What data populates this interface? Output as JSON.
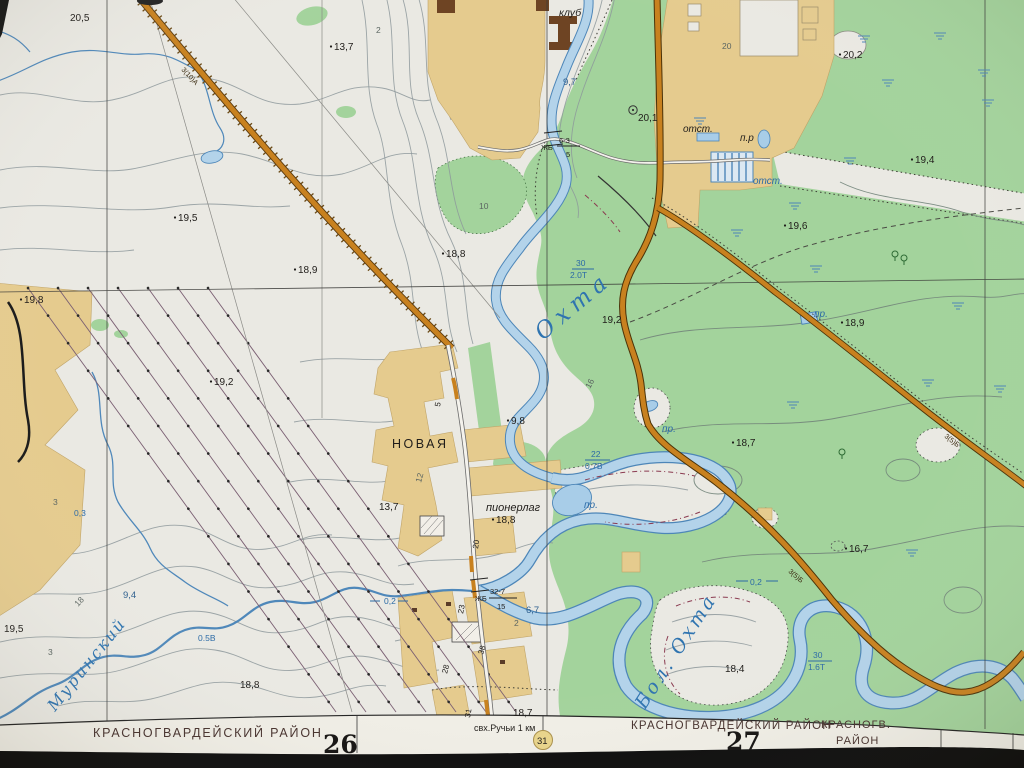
{
  "map": {
    "colors": {
      "paper": "#eae9e3",
      "margin_paper": "#f0eee6",
      "forest_green": "#a3d39c",
      "built_tan": "#e5cb8e",
      "water_fill": "#b3d3ea",
      "water_edge": "#4d86b8",
      "road_orange": "#c8811f",
      "road_edge": "#5a3b10",
      "building_brown": "#6e4423",
      "power_line": "#7a5f72",
      "district_text": "#46312d",
      "photo_edge_black": "#0b0b0b",
      "marker_circle_fill": "#e8d48a"
    },
    "labels": [
      {
        "t": "20,5",
        "x": 70,
        "y": 21,
        "n": "elevation-label"
      },
      {
        "t": "13,7",
        "x": 334,
        "y": 50,
        "dot": 1,
        "n": "elevation-label"
      },
      {
        "t": "19,5",
        "x": 178,
        "y": 221,
        "dot": 1,
        "n": "elevation-label"
      },
      {
        "t": "18,8",
        "x": 446,
        "y": 257,
        "dot": 1,
        "n": "elevation-label"
      },
      {
        "t": "18,9",
        "x": 298,
        "y": 273,
        "dot": 1,
        "n": "elevation-label"
      },
      {
        "t": "19,8",
        "x": 24,
        "y": 303,
        "dot": 1,
        "n": "elevation-label"
      },
      {
        "t": "19,2",
        "x": 214,
        "y": 385,
        "dot": 1,
        "n": "elevation-label"
      },
      {
        "t": "13,7",
        "x": 379,
        "y": 510,
        "n": "elevation-label"
      },
      {
        "t": "19,5",
        "x": 4,
        "y": 632,
        "n": "elevation-label"
      },
      {
        "t": "18,8",
        "x": 240,
        "y": 688,
        "n": "elevation-label"
      },
      {
        "t": "9,4",
        "x": 123,
        "y": 598,
        "c": "bluU",
        "n": "water-elevation-label"
      },
      {
        "t": "0.5В",
        "x": 198,
        "y": 641,
        "c": "bluS",
        "n": "river-depth-label"
      },
      {
        "t": "0,3",
        "x": 74,
        "y": 516,
        "c": "bluS",
        "n": "river-width-label"
      },
      {
        "t": "20,1",
        "x": 638,
        "y": 121,
        "n": "elevation-label"
      },
      {
        "t": "20,2",
        "x": 843,
        "y": 58,
        "dot": 1,
        "n": "elevation-label"
      },
      {
        "t": "19,4",
        "x": 915,
        "y": 163,
        "dot": 1,
        "n": "elevation-label"
      },
      {
        "t": "19,6",
        "x": 788,
        "y": 229,
        "dot": 1,
        "n": "elevation-label"
      },
      {
        "t": "18,9",
        "x": 845,
        "y": 326,
        "dot": 1,
        "n": "elevation-label"
      },
      {
        "t": "18,7",
        "x": 736,
        "y": 446,
        "dot": 1,
        "n": "elevation-label"
      },
      {
        "t": "16,7",
        "x": 849,
        "y": 552,
        "dot": 1,
        "n": "elevation-label"
      },
      {
        "t": "18,4",
        "x": 725,
        "y": 672,
        "n": "elevation-label"
      },
      {
        "t": "19,2",
        "x": 602,
        "y": 323,
        "n": "elevation-label"
      },
      {
        "t": "9,8",
        "x": 511,
        "y": 424,
        "dot": 1,
        "n": "elevation-label"
      },
      {
        "t": "18,8",
        "x": 496,
        "y": 523,
        "dot": 1,
        "n": "elevation-label"
      },
      {
        "t": "18,7",
        "x": 513,
        "y": 716,
        "n": "elevation-label"
      },
      {
        "t": "6,7",
        "x": 526,
        "y": 613,
        "c": "bluU",
        "n": "elevation-label"
      },
      {
        "t": "9,7",
        "x": 563,
        "y": 85,
        "c": "bluU",
        "n": "water-elevation-label"
      },
      {
        "t": "отст.",
        "x": 683,
        "y": 132,
        "c": "blkI",
        "n": "settling-pond-label"
      },
      {
        "t": "п.р",
        "x": 740,
        "y": 141,
        "c": "blkI",
        "n": "pond-label"
      },
      {
        "t": "отст.",
        "x": 753,
        "y": 184,
        "c": "blu",
        "n": "settling-pond-label"
      },
      {
        "t": "пр.",
        "x": 814,
        "y": 317,
        "c": "blu",
        "n": "pond-label"
      },
      {
        "t": "пр.",
        "x": 662,
        "y": 432,
        "c": "blu",
        "n": "pond-label"
      },
      {
        "t": "пр.",
        "x": 584,
        "y": 508,
        "c": "blu",
        "n": "pond-label"
      },
      {
        "t": "30",
        "x": 576,
        "y": 266,
        "c": "bluS",
        "n": "river-width-label"
      },
      {
        "t": "2.0Т",
        "x": 570,
        "y": 278,
        "c": "bluS",
        "n": "river-depth-label"
      },
      {
        "t": "22",
        "x": 591,
        "y": 457,
        "c": "bluS",
        "n": "river-width-label"
      },
      {
        "t": "0.7В",
        "x": 585,
        "y": 469,
        "c": "bluS",
        "n": "river-depth-label"
      },
      {
        "t": "30",
        "x": 813,
        "y": 658,
        "c": "bluS",
        "n": "river-width-label"
      },
      {
        "t": "1.6Т",
        "x": 808,
        "y": 670,
        "c": "bluS",
        "n": "river-depth-label"
      },
      {
        "t": "0,2",
        "x": 750,
        "y": 585,
        "c": "bluS",
        "n": "stream-width-label"
      },
      {
        "t": "0,2",
        "x": 384,
        "y": 604,
        "c": "bluS",
        "n": "stream-width-label"
      },
      {
        "t": "Охта",
        "x": 543,
        "y": 341,
        "c": "riv",
        "s": 23,
        "r": -40,
        "ls": 6,
        "n": "river-name-okhta"
      },
      {
        "t": "Бол. Охта",
        "x": 645,
        "y": 710,
        "c": "riv",
        "s": 19,
        "r": -57,
        "ls": 3,
        "n": "river-name-bolshaya-okhta"
      },
      {
        "t": "Муринский",
        "x": 55,
        "y": 712,
        "c": "riv",
        "s": 16,
        "r": -51,
        "ls": 2,
        "n": "stream-name-murinsky"
      },
      {
        "t": "20",
        "x": 722,
        "y": 49,
        "c": "ctr",
        "n": "contour-label"
      },
      {
        "t": "10",
        "x": 479,
        "y": 209,
        "c": "ctr",
        "n": "contour-label"
      },
      {
        "t": "16",
        "x": 590,
        "y": 389,
        "c": "ctr",
        "r": -62,
        "n": "contour-label"
      },
      {
        "t": "12",
        "x": 421,
        "y": 483,
        "c": "ctr",
        "r": -75,
        "n": "contour-label"
      },
      {
        "t": "3",
        "x": 53,
        "y": 505,
        "c": "ctr",
        "n": "contour-label"
      },
      {
        "t": "3",
        "x": 48,
        "y": 655,
        "c": "ctr",
        "n": "contour-label"
      },
      {
        "t": "18",
        "x": 78,
        "y": 607,
        "c": "ctr",
        "r": -47,
        "n": "contour-label"
      },
      {
        "t": "2",
        "x": 376,
        "y": 33,
        "c": "ctr",
        "n": "contour-label"
      },
      {
        "t": "2",
        "x": 514,
        "y": 626,
        "c": "ctr",
        "n": "contour-label"
      },
      {
        "t": "23",
        "x": 463,
        "y": 614,
        "r": -78,
        "s": 8,
        "n": "street-number"
      },
      {
        "t": "38",
        "x": 483,
        "y": 655,
        "r": -72,
        "s": 8,
        "n": "street-number"
      },
      {
        "t": "28",
        "x": 447,
        "y": 674,
        "r": -75,
        "s": 8,
        "n": "street-number"
      },
      {
        "t": "31",
        "x": 470,
        "y": 718,
        "r": -80,
        "s": 8,
        "n": "street-number"
      },
      {
        "t": "20",
        "x": 478,
        "y": 549,
        "r": -82,
        "s": 8,
        "n": "street-number"
      },
      {
        "t": "5",
        "x": 440,
        "y": 407,
        "r": -80,
        "s": 8,
        "n": "street-number"
      },
      {
        "t": "НОВАЯ",
        "x": 392,
        "y": 448,
        "s": 12.5,
        "ls": 2.5,
        "n": "settlement-label-novaya"
      },
      {
        "t": "пионерлаг",
        "x": 486,
        "y": 511,
        "c": "blkI",
        "s": 11,
        "n": "pioneer-camp-label"
      },
      {
        "t": "клуб",
        "x": 559,
        "y": 16,
        "c": "blkI",
        "s": 10.5,
        "n": "club-label"
      },
      {
        "t": "свх.Ручьи 1 км",
        "x": 474,
        "y": 731,
        "s": 9,
        "n": "route-note"
      },
      {
        "t": "31",
        "x": 537,
        "y": 744,
        "s": 9.5,
        "n": "route-marker-number"
      },
      {
        "t": "ЖБ",
        "x": 541,
        "y": 150,
        "s": 7.5,
        "n": "bridge-label"
      },
      {
        "t": "6-3",
        "x": 559,
        "y": 143,
        "s": 7.5,
        "n": "bridge-label"
      },
      {
        "t": "5",
        "x": 566,
        "y": 157,
        "s": 7.5,
        "n": "bridge-label"
      },
      {
        "t": "ЖБ",
        "x": 475,
        "y": 601,
        "s": 7.5,
        "n": "bridge-label"
      },
      {
        "t": "32-7",
        "x": 490,
        "y": 594,
        "s": 7.5,
        "n": "bridge-label"
      },
      {
        "t": "15",
        "x": 497,
        "y": 609,
        "s": 7.5,
        "n": "bridge-label"
      },
      {
        "t": "3(10)А",
        "x": 181,
        "y": 70,
        "c": "road",
        "r": 47,
        "n": "road-spec-label"
      },
      {
        "t": "3(5)Б",
        "x": 788,
        "y": 572,
        "c": "road",
        "r": 41,
        "n": "road-spec-label"
      },
      {
        "t": "3(5)Б",
        "x": 944,
        "y": 437,
        "c": "road",
        "r": 38,
        "n": "road-spec-label"
      },
      {
        "t": "КРАСНОГВАРДЕЙСКИЙ РАЙОН",
        "x": 93,
        "y": 737,
        "c": "mar",
        "s": 12.5,
        "ls": 1.8,
        "n": "district-name-left"
      },
      {
        "t": "26",
        "x": 323,
        "y": 753,
        "c": "sheet",
        "s": 25,
        "n": "sheet-number-26"
      },
      {
        "t": "КРАСНОГВАРДЕЙСКИЙ РАЙОН",
        "x": 631,
        "y": 729,
        "c": "mar",
        "s": 11.5,
        "ls": 1.2,
        "n": "district-name-right"
      },
      {
        "t": "27",
        "x": 726,
        "y": 750,
        "c": "sheet",
        "s": 25,
        "n": "sheet-number-27"
      },
      {
        "t": "КРАСНОГВ.",
        "x": 821,
        "y": 728,
        "c": "mar",
        "s": 11,
        "ls": 1,
        "n": "district-name-far-right"
      },
      {
        "t": "РАЙОН",
        "x": 836,
        "y": 744,
        "c": "mar",
        "s": 11,
        "ls": 1,
        "n": "district-name-far-right"
      }
    ],
    "symbols": [
      {
        "k": "marsh",
        "x": 700,
        "y": 118
      },
      {
        "k": "marsh",
        "x": 795,
        "y": 203
      },
      {
        "k": "marsh",
        "x": 888,
        "y": 80
      },
      {
        "k": "marsh",
        "x": 984,
        "y": 70
      },
      {
        "k": "marsh",
        "x": 988,
        "y": 100
      },
      {
        "k": "marsh",
        "x": 816,
        "y": 266
      },
      {
        "k": "marsh",
        "x": 928,
        "y": 380
      },
      {
        "k": "marsh",
        "x": 1000,
        "y": 386
      },
      {
        "k": "marsh",
        "x": 793,
        "y": 402
      },
      {
        "k": "marsh",
        "x": 912,
        "y": 550
      },
      {
        "k": "marsh",
        "x": 850,
        "y": 158
      },
      {
        "k": "marsh",
        "x": 737,
        "y": 230
      },
      {
        "k": "marsh",
        "x": 958,
        "y": 303
      },
      {
        "k": "marsh",
        "x": 864,
        "y": 36
      },
      {
        "k": "marsh",
        "x": 940,
        "y": 33
      },
      {
        "k": "tree",
        "x": 895,
        "y": 258
      },
      {
        "k": "tree",
        "x": 904,
        "y": 262
      },
      {
        "k": "tree",
        "x": 842,
        "y": 456
      },
      {
        "k": "geo",
        "x": 633,
        "y": 110
      }
    ]
  }
}
